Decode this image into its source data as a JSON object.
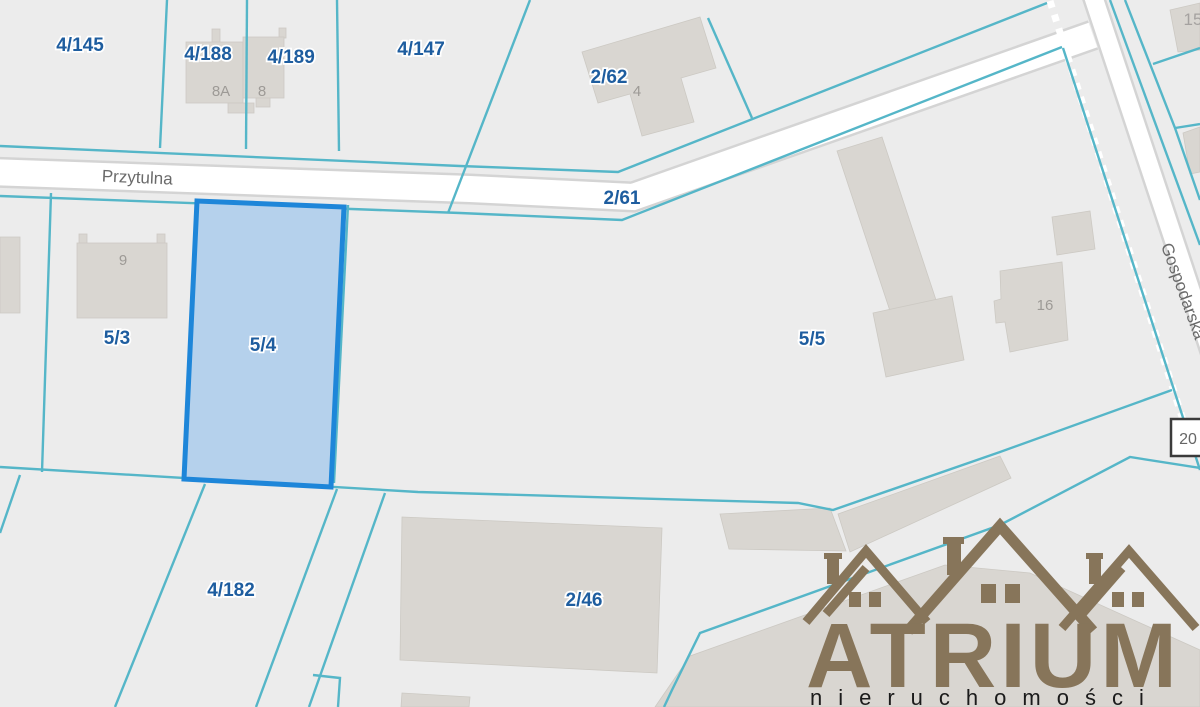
{
  "map": {
    "background": "#ececec",
    "boundary_color": "#55b6c8",
    "road_color": "#ffffff",
    "building_color": "#d9d6d1",
    "label_color": "#1e5d9f",
    "highlight": {
      "parcel": "5/4",
      "fill": "#b5d1ec",
      "border": "#1e86d9"
    },
    "parcel_labels": [
      {
        "text": "4/145"
      },
      {
        "text": "4/188"
      },
      {
        "text": "4/189"
      },
      {
        "text": "4/147"
      },
      {
        "text": "2/62"
      },
      {
        "text": "2/61"
      },
      {
        "text": "5/3"
      },
      {
        "text": "5/4"
      },
      {
        "text": "5/5"
      },
      {
        "text": "4/182"
      },
      {
        "text": "2/46"
      }
    ],
    "building_numbers": [
      {
        "text": "8A"
      },
      {
        "text": "8"
      },
      {
        "text": "4"
      },
      {
        "text": "9"
      },
      {
        "text": "16"
      },
      {
        "text": "15"
      },
      {
        "text": "20"
      }
    ],
    "street_names": [
      {
        "text": "Przytulna"
      },
      {
        "text": "Gospodarska"
      }
    ]
  },
  "watermark": {
    "brand": "ATRIUM",
    "subtitle": "nieruchomości",
    "color": "#87755a"
  }
}
